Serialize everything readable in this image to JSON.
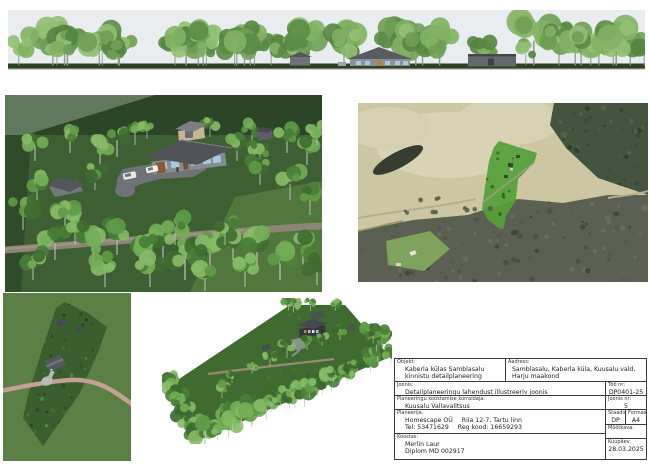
{
  "title_block": {
    "objekt": {
      "label": "Objekt:",
      "line1": "Kaberla külas Samblasalu",
      "line2": "kinnistu detailplaneering"
    },
    "aadress": {
      "label": "Aadress:",
      "line1": "Samblasalu, Kaberla küla, Kuusalu vald,",
      "line2": "Harju maakond"
    },
    "joonis": {
      "label": "Joonis:",
      "value": "Detailplaneeringu lahendust illustreeriv joonis"
    },
    "korraldaja": {
      "label": "Planeeringu koostamise korraldaja:",
      "value": "Kuusalu Vallavalitsus"
    },
    "planeerija": {
      "label": "Planeerija:",
      "company": "Homescape OÜ",
      "address": "Riia 12-7, Tartu linn",
      "tel": "Tel: 53471629",
      "reg": "Reg kood: 16659293"
    },
    "koostas": {
      "label": "Koostas:",
      "name": "Merlin Laur",
      "cert": "Diplom MD 002917"
    },
    "too_nr": {
      "label": "Töö nr:",
      "value": "DP0401-25"
    },
    "joonis_nr": {
      "label": "Joonis nr:",
      "value": "5"
    },
    "staadium": {
      "label": "Staadium:",
      "value": "DP"
    },
    "formaat": {
      "label": "Formaat:",
      "value": "A4"
    },
    "mootkava": {
      "label": "Mõõtkava:",
      "value": ""
    },
    "kuupaev": {
      "label": "Kuupäev:",
      "value": "28.03.2025"
    }
  },
  "colors": {
    "parcel_highlight": "#55a039",
    "lawn_green": "#3e5f33",
    "forest_band": "#2b4526",
    "aerial_field": "#ccc6a3",
    "aerial_forest": "#5c6052",
    "dirt_road": "#8c8474",
    "plan_road": "#c4a095",
    "plan_bg": "#5b7f45",
    "plan_parcel": "#3a5e2e",
    "axon_ground": "#3f6a30",
    "sky": "#e9edef",
    "window_blue": "#a9c6e3"
  }
}
